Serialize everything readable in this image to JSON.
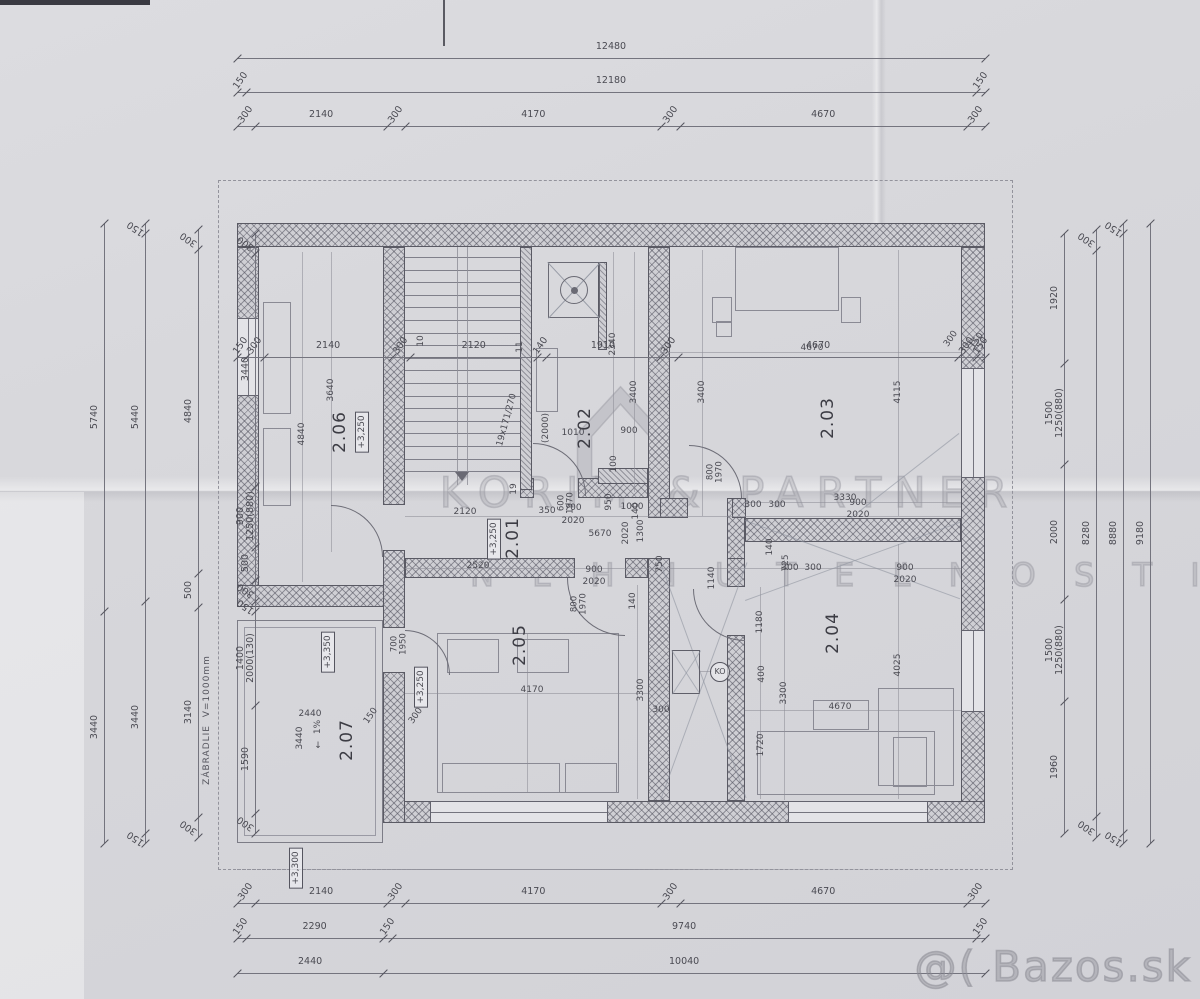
{
  "watermarks": {
    "brand_line1": "KORIM & PARTNER",
    "brand_line2": "N E H N U T E Ľ N O S T I",
    "brand_logo": "⌂",
    "site": "@( Bazos.sk"
  },
  "plan": {
    "rooms": [
      {
        "id": "2.01",
        "level": "+3,250"
      },
      {
        "id": "2.02"
      },
      {
        "id": "2.03"
      },
      {
        "id": "2.04"
      },
      {
        "id": "2.05",
        "level": "+3,250"
      },
      {
        "id": "2.06",
        "level": "+3,250"
      },
      {
        "id": "2.07",
        "level": "+3,350",
        "slope": "1%"
      }
    ],
    "stairs": {
      "treads": 18,
      "note": "19x171/270"
    },
    "railing_note": "ZÁBRADLIE  V=1000mm",
    "balcony_level_below": "+3,300"
  },
  "chains": [
    {
      "id": "top-overall",
      "o": "h",
      "x": 237,
      "y": 58,
      "len": 748,
      "segs": [
        {
          "v": 12480
        }
      ]
    },
    {
      "id": "top-outer",
      "o": "h",
      "x": 237,
      "y": 92,
      "len": 748,
      "segs": [
        {
          "v": 150
        },
        {
          "v": 12180
        },
        {
          "v": 150
        }
      ]
    },
    {
      "id": "top-parts",
      "o": "h",
      "x": 237,
      "y": 126,
      "len": 748,
      "segs": [
        {
          "v": 300
        },
        {
          "v": 2140
        },
        {
          "v": 300
        },
        {
          "v": 4170
        },
        {
          "v": 300
        },
        {
          "v": 4670
        },
        {
          "v": 300
        }
      ]
    },
    {
      "id": "plan-inner",
      "o": "h",
      "x": 237,
      "y": 357,
      "len": 748,
      "segs": [
        {
          "v": 150
        },
        {
          "v": 300
        },
        {
          "v": 2140
        },
        {
          "v": 300
        },
        {
          "v": 2120
        },
        {
          "v": 140
        },
        {
          "v": 1910
        },
        {
          "v": 300
        },
        {
          "v": 4670
        },
        {
          "v": 300
        },
        {
          "v": 150
        }
      ]
    },
    {
      "id": "bottom-parts",
      "o": "h",
      "x": 237,
      "y": 903,
      "len": 748,
      "segs": [
        {
          "v": 300
        },
        {
          "v": 2140
        },
        {
          "v": 300
        },
        {
          "v": 4170
        },
        {
          "v": 300
        },
        {
          "v": 4670
        },
        {
          "v": 300
        }
      ]
    },
    {
      "id": "bottom-mid",
      "o": "h",
      "x": 237,
      "y": 938,
      "len": 748,
      "segs": [
        {
          "v": 150
        },
        {
          "v": 2290
        },
        {
          "v": 150
        },
        {
          "v": 9740
        },
        {
          "v": 150
        }
      ]
    },
    {
      "id": "bottom-overall",
      "o": "h",
      "x": 237,
      "y": 973,
      "len": 748,
      "segs": [
        {
          "v": 2440
        },
        {
          "v": 10040
        }
      ]
    },
    {
      "id": "left-1",
      "o": "v",
      "x": 255,
      "y": 233,
      "len": 600,
      "segs": [
        {
          "v": 300
        },
        {
          "v": 3440
        },
        {
          "v": 900,
          "sub": "1250(880)"
        },
        {
          "v": 500
        },
        {
          "v": 300
        },
        {
          "v": 150
        },
        {
          "v": 1400,
          "sub": "2000(130)"
        },
        {
          "v": 1590
        },
        {
          "v": 300
        }
      ]
    },
    {
      "id": "left-2",
      "o": "v",
      "x": 198,
      "y": 229,
      "len": 608,
      "segs": [
        {
          "v": 300
        },
        {
          "v": 4840
        },
        {
          "v": 500
        },
        {
          "v": 3140
        },
        {
          "v": 300
        }
      ]
    },
    {
      "id": "left-3",
      "o": "v",
      "x": 145,
      "y": 223,
      "len": 620,
      "segs": [
        {
          "v": 150
        },
        {
          "v": 5440
        },
        {
          "v": 3440
        },
        {
          "v": 150
        }
      ]
    },
    {
      "id": "left-4",
      "o": "v",
      "x": 104,
      "y": 223,
      "len": 620,
      "segs": [
        {
          "v": 5740
        },
        {
          "v": 3440
        }
      ]
    },
    {
      "id": "right-1",
      "o": "v",
      "x": 1064,
      "y": 233,
      "len": 600,
      "segs": [
        {
          "v": 1920
        },
        {
          "v": 1500,
          "sub": "1250(880)"
        },
        {
          "v": 2000
        },
        {
          "v": 1500,
          "sub": "1250(880)"
        },
        {
          "v": 1960
        }
      ]
    },
    {
      "id": "right-2",
      "o": "v",
      "x": 1096,
      "y": 229,
      "len": 608,
      "segs": [
        {
          "v": 300
        },
        {
          "v": 8280
        },
        {
          "v": 300
        }
      ]
    },
    {
      "id": "right-3",
      "o": "v",
      "x": 1123,
      "y": 223,
      "len": 620,
      "segs": [
        {
          "v": 150
        },
        {
          "v": 8880
        },
        {
          "v": 150
        }
      ]
    },
    {
      "id": "right-4",
      "o": "v",
      "x": 1150,
      "y": 223,
      "len": 620,
      "segs": [
        {
          "v": 9180
        }
      ]
    }
  ],
  "labels": [
    {
      "t": "2.06",
      "x": 340,
      "y": 432,
      "r": -90,
      "c": "rm"
    },
    {
      "t": "+3,250",
      "x": 362,
      "y": 432,
      "r": -90,
      "c": "lv"
    },
    {
      "t": "2.02",
      "x": 585,
      "y": 428,
      "r": -90,
      "c": "rm"
    },
    {
      "t": "2.03",
      "x": 828,
      "y": 418,
      "r": -90,
      "c": "rm"
    },
    {
      "t": "2.01",
      "x": 513,
      "y": 538,
      "r": -90,
      "c": "rm"
    },
    {
      "t": "+3,250",
      "x": 494,
      "y": 539,
      "r": -90,
      "c": "lv"
    },
    {
      "t": "2.05",
      "x": 520,
      "y": 645,
      "r": -90,
      "c": "rm"
    },
    {
      "t": "2.04",
      "x": 833,
      "y": 633,
      "r": -90,
      "c": "rm"
    },
    {
      "t": "2.07",
      "x": 347,
      "y": 740,
      "r": -90,
      "c": "rm"
    },
    {
      "t": "+3,350",
      "x": 328,
      "y": 652,
      "r": -90,
      "c": "lv"
    },
    {
      "t": "+3,250",
      "x": 421,
      "y": 687,
      "r": -90,
      "c": "lv"
    },
    {
      "t": "+3,300",
      "x": 296,
      "y": 868,
      "r": -90,
      "c": "lv"
    },
    {
      "t": "1%",
      "x": 318,
      "y": 727,
      "r": -90,
      "c": "s"
    },
    {
      "t": "↓",
      "x": 318,
      "y": 746,
      "r": 0,
      "c": "s"
    },
    {
      "t": "2440",
      "x": 310,
      "y": 714,
      "r": 0,
      "c": "s"
    },
    {
      "t": "150",
      "x": 371,
      "y": 716,
      "r": -55,
      "c": "s"
    },
    {
      "t": "300",
      "x": 416,
      "y": 716,
      "r": -55,
      "c": "s"
    },
    {
      "t": "3440",
      "x": 300,
      "y": 738,
      "r": -90,
      "c": "s"
    },
    {
      "t": "ZÁBRADLIE  V=1000mm",
      "x": 207,
      "y": 720,
      "r": -90,
      "c": "n"
    },
    {
      "t": "19x171/270",
      "x": 507,
      "y": 420,
      "r": -75,
      "c": "s"
    },
    {
      "t": "(2000)",
      "x": 546,
      "y": 428,
      "r": -90,
      "c": "s"
    },
    {
      "t": "19",
      "x": 514,
      "y": 489,
      "r": -90,
      "c": "s"
    },
    {
      "t": "10",
      "x": 421,
      "y": 341,
      "r": -90,
      "c": "s"
    },
    {
      "t": "11",
      "x": 520,
      "y": 347,
      "r": -90,
      "c": "s"
    },
    {
      "t": "2340",
      "x": 613,
      "y": 344,
      "r": -90,
      "c": "s"
    },
    {
      "t": "3400",
      "x": 634,
      "y": 392,
      "r": -90,
      "c": "s"
    },
    {
      "t": "1010",
      "x": 573,
      "y": 433,
      "r": 0,
      "c": "s"
    },
    {
      "t": "900",
      "x": 629,
      "y": 431,
      "r": 0,
      "c": "s"
    },
    {
      "t": "100",
      "x": 614,
      "y": 464,
      "r": -90,
      "c": "s"
    },
    {
      "t": "950",
      "x": 609,
      "y": 502,
      "r": -90,
      "c": "s"
    },
    {
      "t": "140",
      "x": 636,
      "y": 511,
      "r": -90,
      "c": "s"
    },
    {
      "t": "600\n1970",
      "x": 567,
      "y": 503,
      "r": -90,
      "c": "d"
    },
    {
      "t": "800\n1970",
      "x": 716,
      "y": 472,
      "r": -90,
      "c": "d"
    },
    {
      "t": "800\n1970",
      "x": 580,
      "y": 604,
      "r": -90,
      "c": "d"
    },
    {
      "t": "700\n1950",
      "x": 400,
      "y": 644,
      "r": -90,
      "c": "d"
    },
    {
      "t": "4670",
      "x": 812,
      "y": 348,
      "r": 0,
      "c": "s"
    },
    {
      "t": "3400",
      "x": 702,
      "y": 392,
      "r": -90,
      "c": "s"
    },
    {
      "t": "4115",
      "x": 898,
      "y": 392,
      "r": -90,
      "c": "s"
    },
    {
      "t": "3330",
      "x": 845,
      "y": 498,
      "r": 0,
      "c": "s"
    },
    {
      "t": "150",
      "x": 977,
      "y": 341,
      "r": -55,
      "c": "s"
    },
    {
      "t": "300",
      "x": 951,
      "y": 339,
      "r": -55,
      "c": "s"
    },
    {
      "t": "2120",
      "x": 465,
      "y": 512,
      "r": 0,
      "c": "s"
    },
    {
      "t": "350",
      "x": 547,
      "y": 511,
      "r": 0,
      "c": "s"
    },
    {
      "t": "700",
      "x": 573,
      "y": 508,
      "r": 0,
      "c": "s"
    },
    {
      "t": "2020",
      "x": 573,
      "y": 521,
      "r": 0,
      "c": "s"
    },
    {
      "t": "1000",
      "x": 632,
      "y": 507,
      "r": 0,
      "c": "s"
    },
    {
      "t": "300",
      "x": 753,
      "y": 505,
      "r": 0,
      "c": "s"
    },
    {
      "t": "300",
      "x": 777,
      "y": 505,
      "r": 0,
      "c": "s"
    },
    {
      "t": "900",
      "x": 858,
      "y": 503,
      "r": 0,
      "c": "s"
    },
    {
      "t": "2020",
      "x": 858,
      "y": 515,
      "r": 0,
      "c": "s"
    },
    {
      "t": "5670",
      "x": 600,
      "y": 534,
      "r": 0,
      "c": "s"
    },
    {
      "t": "2520",
      "x": 478,
      "y": 566,
      "r": 0,
      "c": "s"
    },
    {
      "t": "900",
      "x": 594,
      "y": 570,
      "r": 0,
      "c": "s"
    },
    {
      "t": "2020",
      "x": 594,
      "y": 582,
      "r": 0,
      "c": "s"
    },
    {
      "t": "750",
      "x": 660,
      "y": 564,
      "r": -90,
      "c": "s"
    },
    {
      "t": "1300",
      "x": 641,
      "y": 531,
      "r": -90,
      "c": "s"
    },
    {
      "t": "2020",
      "x": 626,
      "y": 533,
      "r": -90,
      "c": "s"
    },
    {
      "t": "1140",
      "x": 712,
      "y": 578,
      "r": -90,
      "c": "s"
    },
    {
      "t": "300",
      "x": 790,
      "y": 568,
      "r": 0,
      "c": "s"
    },
    {
      "t": "300",
      "x": 813,
      "y": 568,
      "r": 0,
      "c": "s"
    },
    {
      "t": "900",
      "x": 905,
      "y": 568,
      "r": 0,
      "c": "s"
    },
    {
      "t": "2020",
      "x": 905,
      "y": 580,
      "r": 0,
      "c": "s"
    },
    {
      "t": "725",
      "x": 786,
      "y": 563,
      "r": -90,
      "c": "s"
    },
    {
      "t": "140",
      "x": 770,
      "y": 547,
      "r": -90,
      "c": "s"
    },
    {
      "t": "1180",
      "x": 760,
      "y": 622,
      "r": -90,
      "c": "s"
    },
    {
      "t": "400",
      "x": 762,
      "y": 674,
      "r": -90,
      "c": "s"
    },
    {
      "t": "3300",
      "x": 784,
      "y": 693,
      "r": -90,
      "c": "s"
    },
    {
      "t": "4670",
      "x": 840,
      "y": 707,
      "r": 0,
      "c": "s"
    },
    {
      "t": "4025",
      "x": 898,
      "y": 665,
      "r": -90,
      "c": "s"
    },
    {
      "t": "1720",
      "x": 761,
      "y": 745,
      "r": -90,
      "c": "s"
    },
    {
      "t": "4170",
      "x": 532,
      "y": 690,
      "r": 0,
      "c": "s"
    },
    {
      "t": "3300",
      "x": 641,
      "y": 690,
      "r": -90,
      "c": "s"
    },
    {
      "t": "300",
      "x": 661,
      "y": 710,
      "r": 0,
      "c": "s"
    },
    {
      "t": "140",
      "x": 633,
      "y": 601,
      "r": -90,
      "c": "s"
    },
    {
      "t": "3640",
      "x": 331,
      "y": 390,
      "r": -90,
      "c": "s"
    },
    {
      "t": "4840",
      "x": 302,
      "y": 434,
      "r": -90,
      "c": "s"
    },
    {
      "t": "KO",
      "x": 720,
      "y": 672,
      "r": 0,
      "c": "ko"
    }
  ]
}
